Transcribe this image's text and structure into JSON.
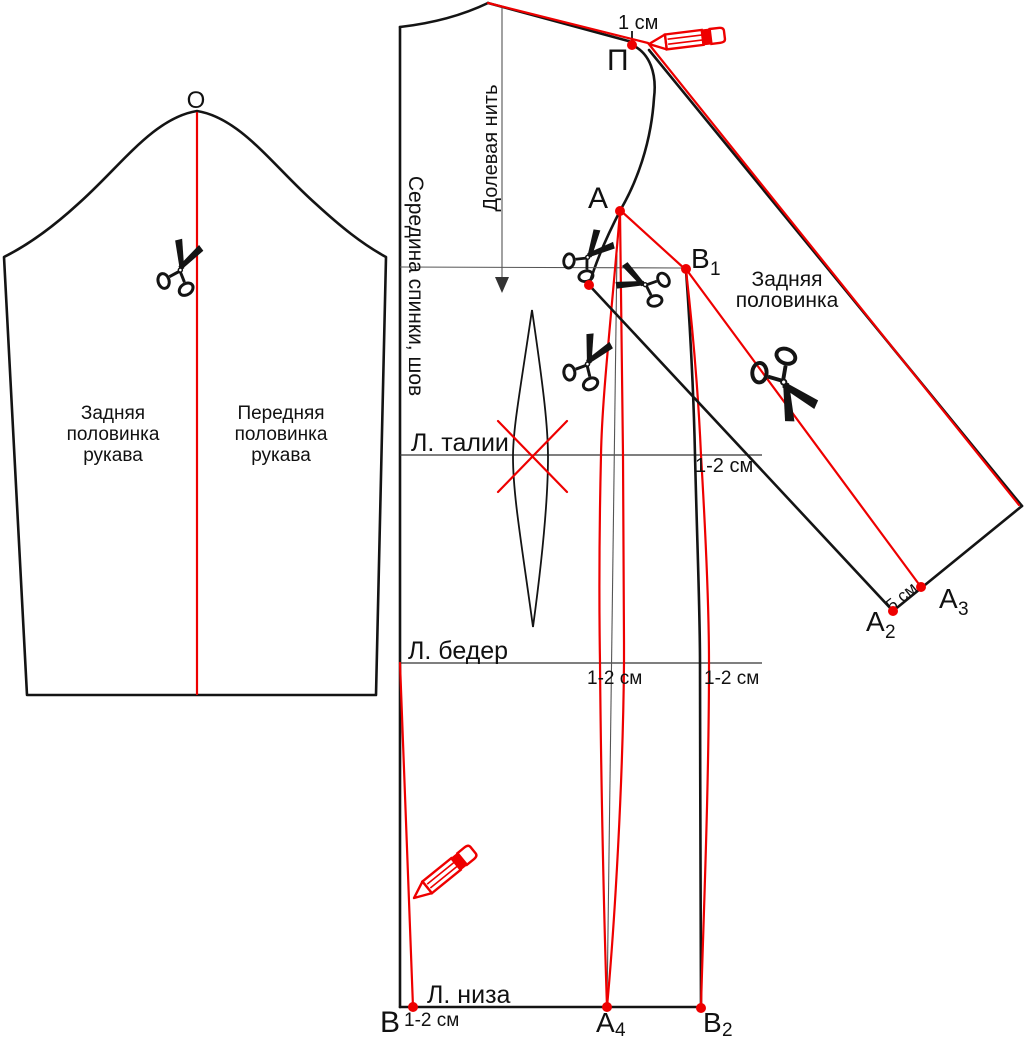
{
  "colors": {
    "red": "#ee0000",
    "black": "#141414",
    "guide": "#555555"
  },
  "sleeve": {
    "point_o": "О",
    "back_half_lines": [
      "Задняя",
      "половинка",
      "рукава"
    ],
    "front_half_lines": [
      "Передняя",
      "половинка",
      "рукава"
    ]
  },
  "bodice": {
    "grain_line": "Долевая нить",
    "center_back": "Середина спинки, шов",
    "waist_line": "Л. талии",
    "hip_line": "Л. бедер",
    "hem_line": "Л. низа",
    "cm_1": "1 см",
    "cm_1_2_waist": "1-2 см",
    "cm_1_2_hip_left": "1-2 см",
    "cm_1_2_hip_right": "1-2 см",
    "cm_1_2_hem": "1-2 см",
    "points": {
      "p": "П",
      "a": "А",
      "b1_base": "В",
      "b1_sub": "1",
      "b": "В",
      "a4_base": "А",
      "a4_sub": "4",
      "b2_base": "В",
      "b2_sub": "2"
    }
  },
  "sleeve_piece": {
    "label_lines": [
      "Задняя",
      "половинка"
    ],
    "cm_5": "5 см",
    "points": {
      "a2_base": "А",
      "a2_sub": "2",
      "a3_base": "А",
      "a3_sub": "3"
    }
  }
}
